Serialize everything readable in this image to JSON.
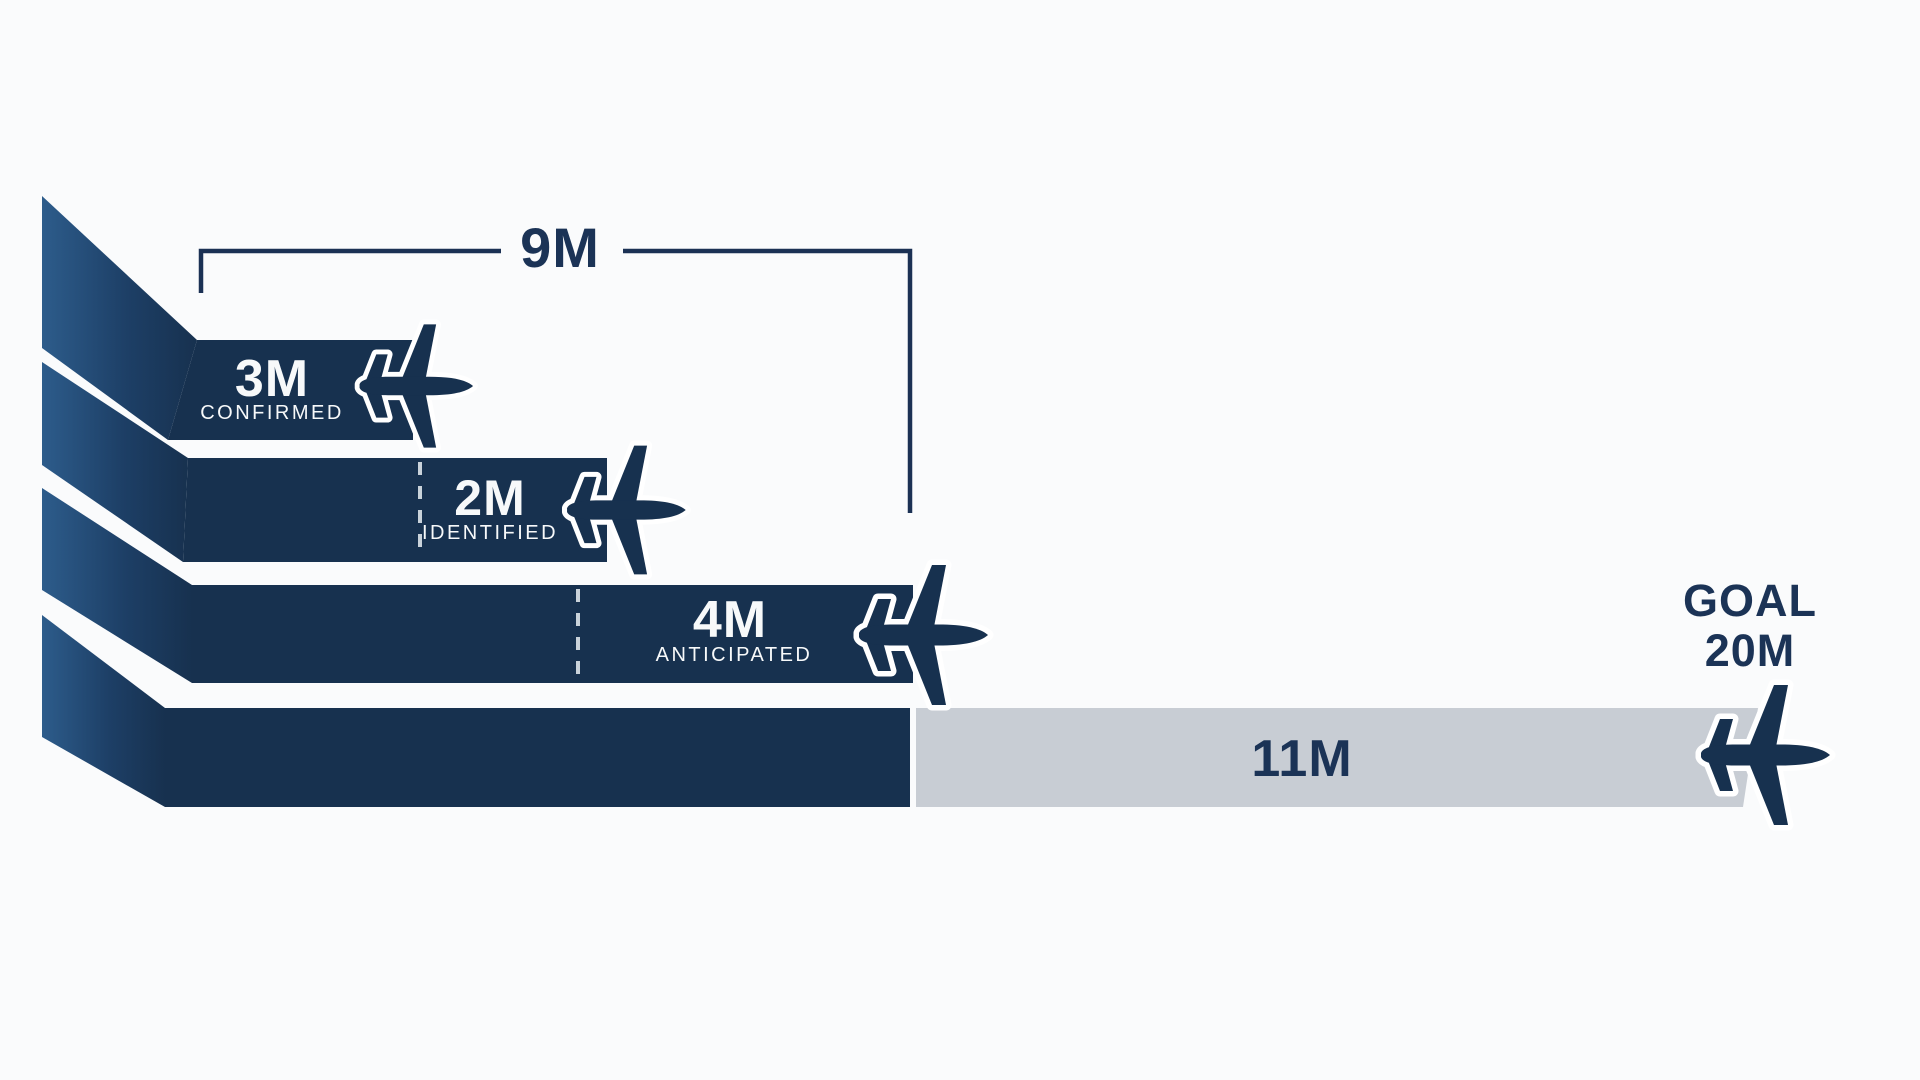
{
  "colors": {
    "navy": "#17314f",
    "navy_text": "#1b3356",
    "funnel_gradient_light": "#2d5c8b",
    "remaining_gray": "#c8cdd4",
    "background": "#fafbfc",
    "white_text": "#f7f9fa"
  },
  "bracket": {
    "label": "9M"
  },
  "bars": [
    {
      "value": "3M",
      "status": "CONFIRMED"
    },
    {
      "value": "2M",
      "status": "IDENTIFIED"
    },
    {
      "value": "4M",
      "status": "ANTICIPATED"
    }
  ],
  "remaining_label": "11M",
  "goal": {
    "title": "GOAL",
    "value": "20M"
  },
  "icons": [
    "airplane-icon",
    "airplane-icon",
    "airplane-icon",
    "airplane-icon"
  ],
  "chart_data": {
    "type": "funnel",
    "unit": "millions",
    "orientation": "horizontal stacked progress bars",
    "segments": [
      {
        "label": "CONFIRMED",
        "display": "3M",
        "value": 3
      },
      {
        "label": "IDENTIFIED",
        "display": "2M",
        "value": 2
      },
      {
        "label": "ANTICIPATED",
        "display": "4M",
        "value": 4
      }
    ],
    "subtotal": {
      "display": "9M",
      "value": 9
    },
    "remaining": {
      "display": "11M",
      "value": 11
    },
    "goal": {
      "label": "GOAL",
      "display": "20M",
      "value": 20
    },
    "notes": "Navy funnel fans from the left into four bars; 3M confirmed + 2M identified + 4M anticipated = 9M (bracket), gray bar shows 11M remaining toward the 20M goal; each bar ends with an airplane icon."
  }
}
